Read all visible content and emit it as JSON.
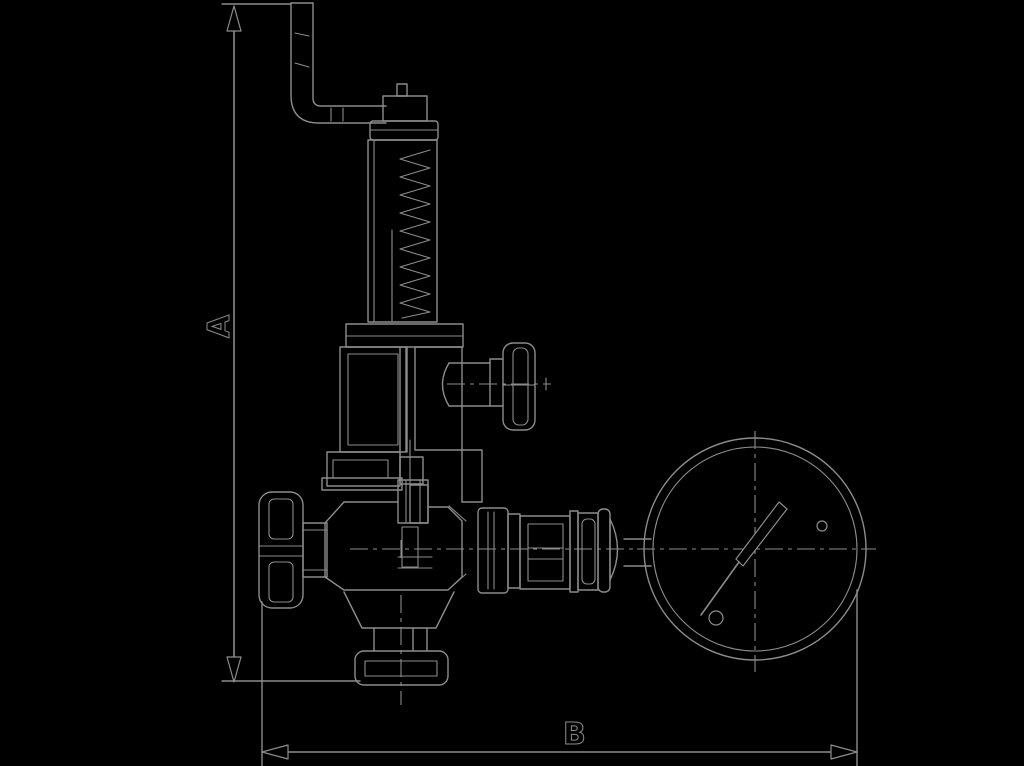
{
  "labels": {
    "dimension_a": "A",
    "dimension_b": "B"
  },
  "colors": {
    "background": "#000000",
    "line": "#8c8c8c",
    "fill": "#000000"
  }
}
